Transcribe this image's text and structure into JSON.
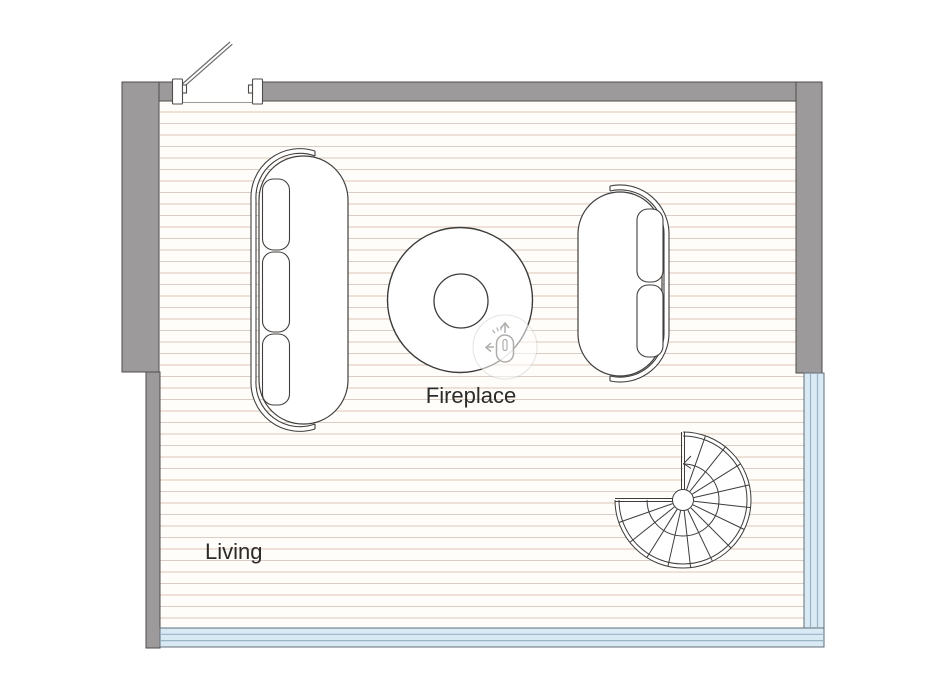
{
  "plan": {
    "labels": {
      "room": "Living",
      "fireplace": "Fireplace"
    },
    "objects": {
      "door": "hinged-door-open",
      "sofa_left": "three-seat-sofa",
      "sofa_right": "two-seat-sofa",
      "fireplace": "round-fireplace-table",
      "stair": "spiral-staircase",
      "window_right": "window-band-right",
      "window_bottom": "window-band-bottom"
    },
    "icons": {
      "hint": "mouse-pan-hint-icon"
    },
    "colors": {
      "wall": "#9c9a9a",
      "wall_edge": "#4f4c49",
      "floor_bg": "#fffdfa",
      "floor_line": "#dcc6b5",
      "window_fill": "#d9eaf4",
      "window_frame": "#5f6e78",
      "window_pane": "#9ab4c6",
      "outline": "#3e3c3a",
      "label_text": "#2d2b29",
      "hint_gray": "#b0adaa"
    }
  }
}
